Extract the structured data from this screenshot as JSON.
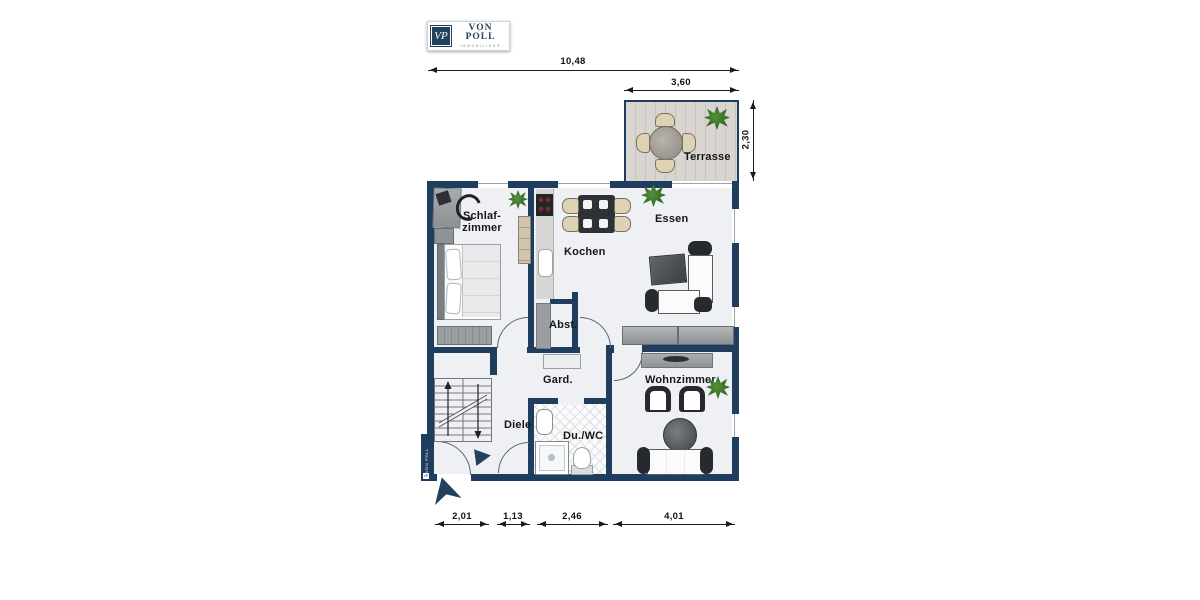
{
  "logo": {
    "vp": "VP",
    "name": "VON POLL",
    "subtitle": "IMMOBILIEN®"
  },
  "watermark": {
    "text": "VON POLL",
    "vp": "VP"
  },
  "dimensions": {
    "total_width": "10,48",
    "terrace_width": "3,60",
    "terrace_depth": "2,30",
    "bottom": [
      {
        "label": "2,01"
      },
      {
        "label": "1,13"
      },
      {
        "label": "2,46"
      },
      {
        "label": "4,01"
      }
    ]
  },
  "rooms": {
    "terrasse": "Terrasse",
    "schlafzimmer_line1": "Schlaf-",
    "schlafzimmer_line2": "zimmer",
    "kochen": "Kochen",
    "essen": "Essen",
    "abst": "Abst.",
    "gard": "Gard.",
    "diele": "Diele",
    "duwc": "Du./WC",
    "wohnzimmer": "Wohnzimmer"
  },
  "colors": {
    "wall": "#1f3d5f",
    "floor": "#eef0f3",
    "deck": "#d9d6d2",
    "accent": "#23415f",
    "plant": "#3c7a2a"
  }
}
